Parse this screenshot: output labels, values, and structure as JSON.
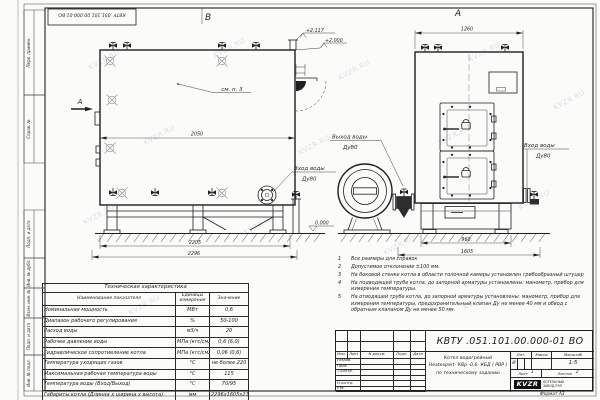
{
  "colors": {
    "line": "#1f1f1f",
    "paper": "#fbfbfa",
    "watermark": "#dbdfe1",
    "logo_bg": "#111111"
  },
  "watermark_text": "KVZR.RU",
  "corner_stamp": "КВТУ .051.101.00.000-01 ВО",
  "margin_labels": [
    "Перв. примен.",
    "Справ. №",
    "Подп. и дата",
    "Инв. № дубл.",
    "Взам. инв. №",
    "Подп. и дата",
    "Инв. № подл."
  ],
  "drawing": {
    "view_b": {
      "label": "В",
      "section_label": "А",
      "callout": "см. п. 3",
      "dim_inner": "2050",
      "dim_base": "2205",
      "dim_overall": "2296",
      "inlet_label": "Вход воды",
      "inlet_dn": "Ду80"
    },
    "middle": {
      "outlet_label": "Выход воды",
      "outlet_dn": "Ду80"
    },
    "view_a": {
      "label": "А",
      "dim_top": "1260",
      "dim_base": "960",
      "dim_overall": "1605",
      "inlet_label": "Вход воды",
      "inlet_dn": "Ду80"
    },
    "elevations": {
      "duct_top": "+2.117",
      "boiler_top": "+2.000",
      "ground": "0.000"
    }
  },
  "notes": {
    "items": [
      {
        "num": "1",
        "text": "Все размеры для справок"
      },
      {
        "num": "2",
        "text": "Допустимое отклонение ±100 мм."
      },
      {
        "num": "3",
        "text": "На боковой стенке котла в области топочной камеры установлен грибообразный штуцер"
      },
      {
        "num": "4",
        "text": "На подводящей трубе котла, до запорной арматуры установлены: манометр, прибор для измерения температуры."
      },
      {
        "num": "5",
        "text": "На отводящей трубе котла, до запорной арматуры установлены: манометр, прибор для измерения температуры, предохранительный клапан Ду не менее 40 мм и обвод с обратным клапаном Ду не менее 50 мм."
      }
    ]
  },
  "tech_table": {
    "title": "Техническая характеристика",
    "col_name": "Наименование показателя",
    "col_units": "Единицы измерения",
    "col_value": "Значение",
    "rows": [
      {
        "name": "Номинальная мощность",
        "units": "МВт",
        "value": "0,6"
      },
      {
        "name": "Диапазон рабочего регулирования",
        "units": "%",
        "value": "50-100"
      },
      {
        "name": "Расход воды",
        "units": "м3/ч",
        "value": "20"
      },
      {
        "name": "Рабочее давление воды",
        "units": "МПа (кгс/см2)",
        "value": "0,6 (6,0)"
      },
      {
        "name": "Гидравлическое сопротивление котла",
        "units": "МПа (кгс/см2)",
        "value": "0,06 (0,6)"
      },
      {
        "name": "Температура уходящих газов",
        "units": "°С",
        "value": "не более 220"
      },
      {
        "name": "Максимальная рабочая температура воды",
        "units": "°С",
        "value": "115"
      },
      {
        "name": "Температура воды (Вход/Выход)",
        "units": "°С",
        "value": "70/95"
      },
      {
        "name": "Габариты котла (Длинна х ширина х высота)",
        "units": "мм",
        "value": "2296х1605х2117"
      }
    ]
  },
  "title_block": {
    "doc_number": "КВТУ .051.101.00.000-01  ВО",
    "designation_line1": "Котел водогрейный",
    "designation_line2": "Heatexpert- КВр -0,6- КБД ( РВР )",
    "designation_line3": "по техническому заданию",
    "col_izm": "Изм.",
    "col_list": "Лист",
    "col_docnum": "N докум.",
    "col_podp": "Подп.",
    "col_data": "Дата",
    "row_razrab": "Разраб.",
    "row_prov": "Пров.",
    "row_tkontr": "Т.контр.",
    "row_nkontr": "Н.контр.",
    "row_utv": "Утв.",
    "lit_label": "Лит.",
    "lit_value": "И",
    "massa_label": "Масса",
    "masshtab_label": "Масштаб",
    "masshtab_value": "1:5",
    "list_label": "Лист",
    "list_value": "1",
    "listov_label": "Листов",
    "listov_value": "2",
    "logo_text": "KVZR",
    "logo_caption_1": "КОТЕЛЬНЫЙ",
    "logo_caption_2": "ЗАВОД РЭП",
    "format_label": "Формат",
    "format_value": "А3"
  }
}
